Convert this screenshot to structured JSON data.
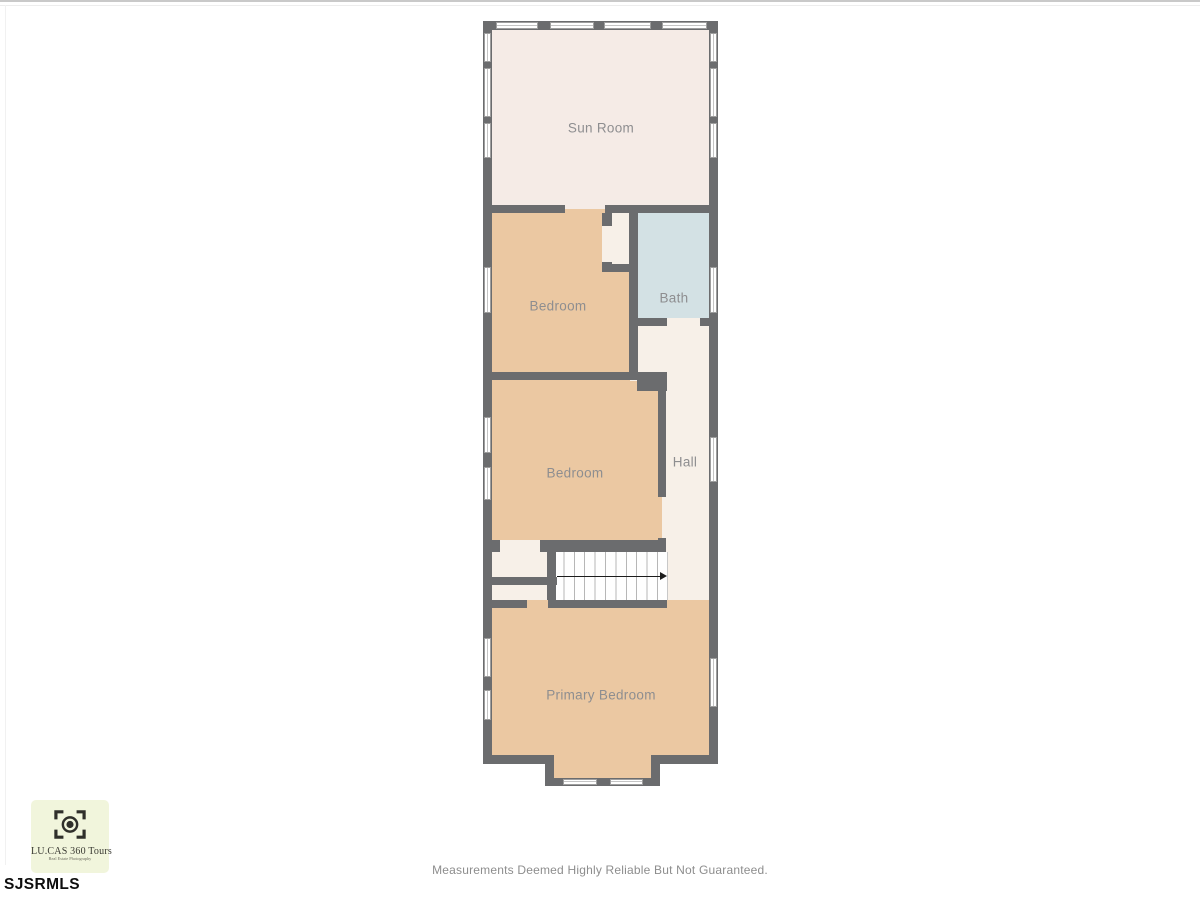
{
  "floorplan": {
    "rooms": {
      "sunroom": {
        "label": "Sun Room"
      },
      "bedroom1": {
        "label": "Bedroom"
      },
      "bath": {
        "label": "Bath"
      },
      "bedroom2": {
        "label": "Bedroom"
      },
      "hall": {
        "label": "Hall"
      },
      "primary": {
        "label": "Primary Bedroom"
      }
    },
    "stairs_direction": "right"
  },
  "branding": {
    "logo_title": "LU.CAS 360 Tours",
    "logo_subtitle": "Real Estate Photography",
    "mls": "SJSRMLS"
  },
  "footer": {
    "disclaimer": "Measurements Deemed Highly Reliable But Not Guaranteed."
  },
  "colors": {
    "wall": "#6b6c6e",
    "bedroom_fill": "#ebc8a2",
    "sunroom_fill": "#f5ebe6",
    "hall_fill": "#f7f0e8",
    "bath_fill": "#d3e1e4",
    "stairs_fill": "#fefefe",
    "label_text": "#8e8e90",
    "logo_background": "#f1f5dc"
  }
}
